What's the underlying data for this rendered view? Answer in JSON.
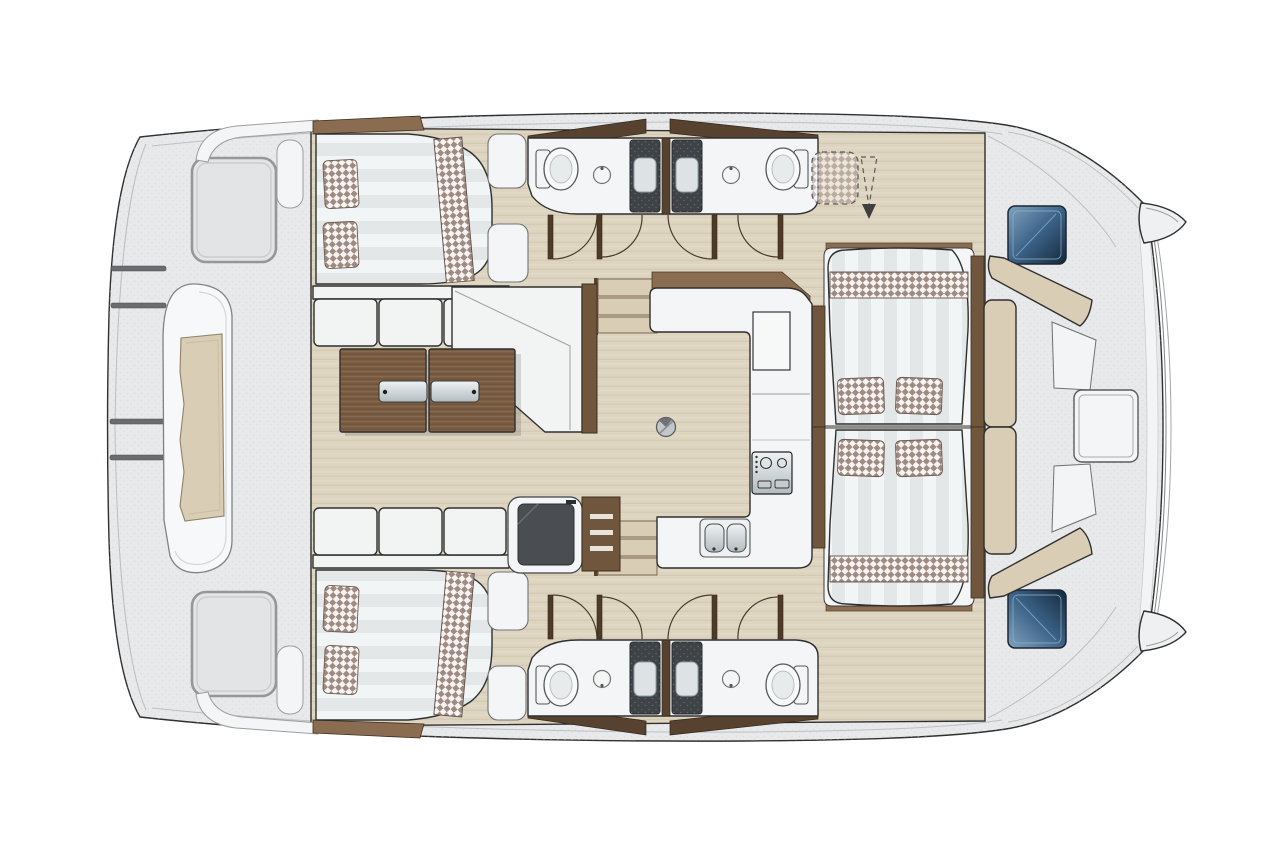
{
  "diagram": {
    "type": "catamaran-yacht-floor-plan",
    "view": "top-down",
    "orientation": "bow-right-stern-left"
  },
  "colors": {
    "outline": "#2f2f2f",
    "deck-gray": "#e8e9ea",
    "speckle": "#d2d3d5",
    "platform-white": "#f4f5f6",
    "bench-white": "#f2f3f3",
    "wood-floor": "#ded5c1",
    "wood-floor-line": "#d0c6af",
    "wood-brown": "#7b5e44",
    "wood-grain-dark": "#6a4f37",
    "wood-brown-dark": "#57422f",
    "wood-trim": "#8a6d51",
    "plank": "#6f563c",
    "mattress-light": "#f2f5f5",
    "mattress-dark": "#e3e7e8",
    "check-brown": "#a08b82",
    "check-bg": "#f7f4f2",
    "cushion-beige": "#d9cdb5",
    "appliance-dark": "#4a4e52",
    "shower-dark": "#3e4347",
    "hatch-blue-light": "#7fa3bf",
    "hatch-blue-mid": "#3c6288",
    "hatch-blue-dark": "#15283a",
    "metal-light": "#eef2f4",
    "metal-dark": "#b2bcc0",
    "arc-brown": "#4a3b2b",
    "door-leaf": "#4f3a28"
  },
  "features": {
    "hull_double_beds": 2,
    "forward_double_beds": 2,
    "checkered_pillows_per_hull_bed": 2,
    "forward_bed_cushions": 4,
    "toilets": 4,
    "bathroom_sinks": 4,
    "shower_stalls": 4,
    "door_swings": 8,
    "galley_burners": 2,
    "galley_sink_basins": 2,
    "salon_sofa_cushions": 3,
    "coffee_table_sections": 2,
    "bow_deck_hatches": 2,
    "bow_cockpit_table": 1,
    "stern_davit_bars": 4,
    "tender_dinghy": 1,
    "stair_steps_per_side": 3,
    "optional_helm_seat_dashed": 1
  }
}
